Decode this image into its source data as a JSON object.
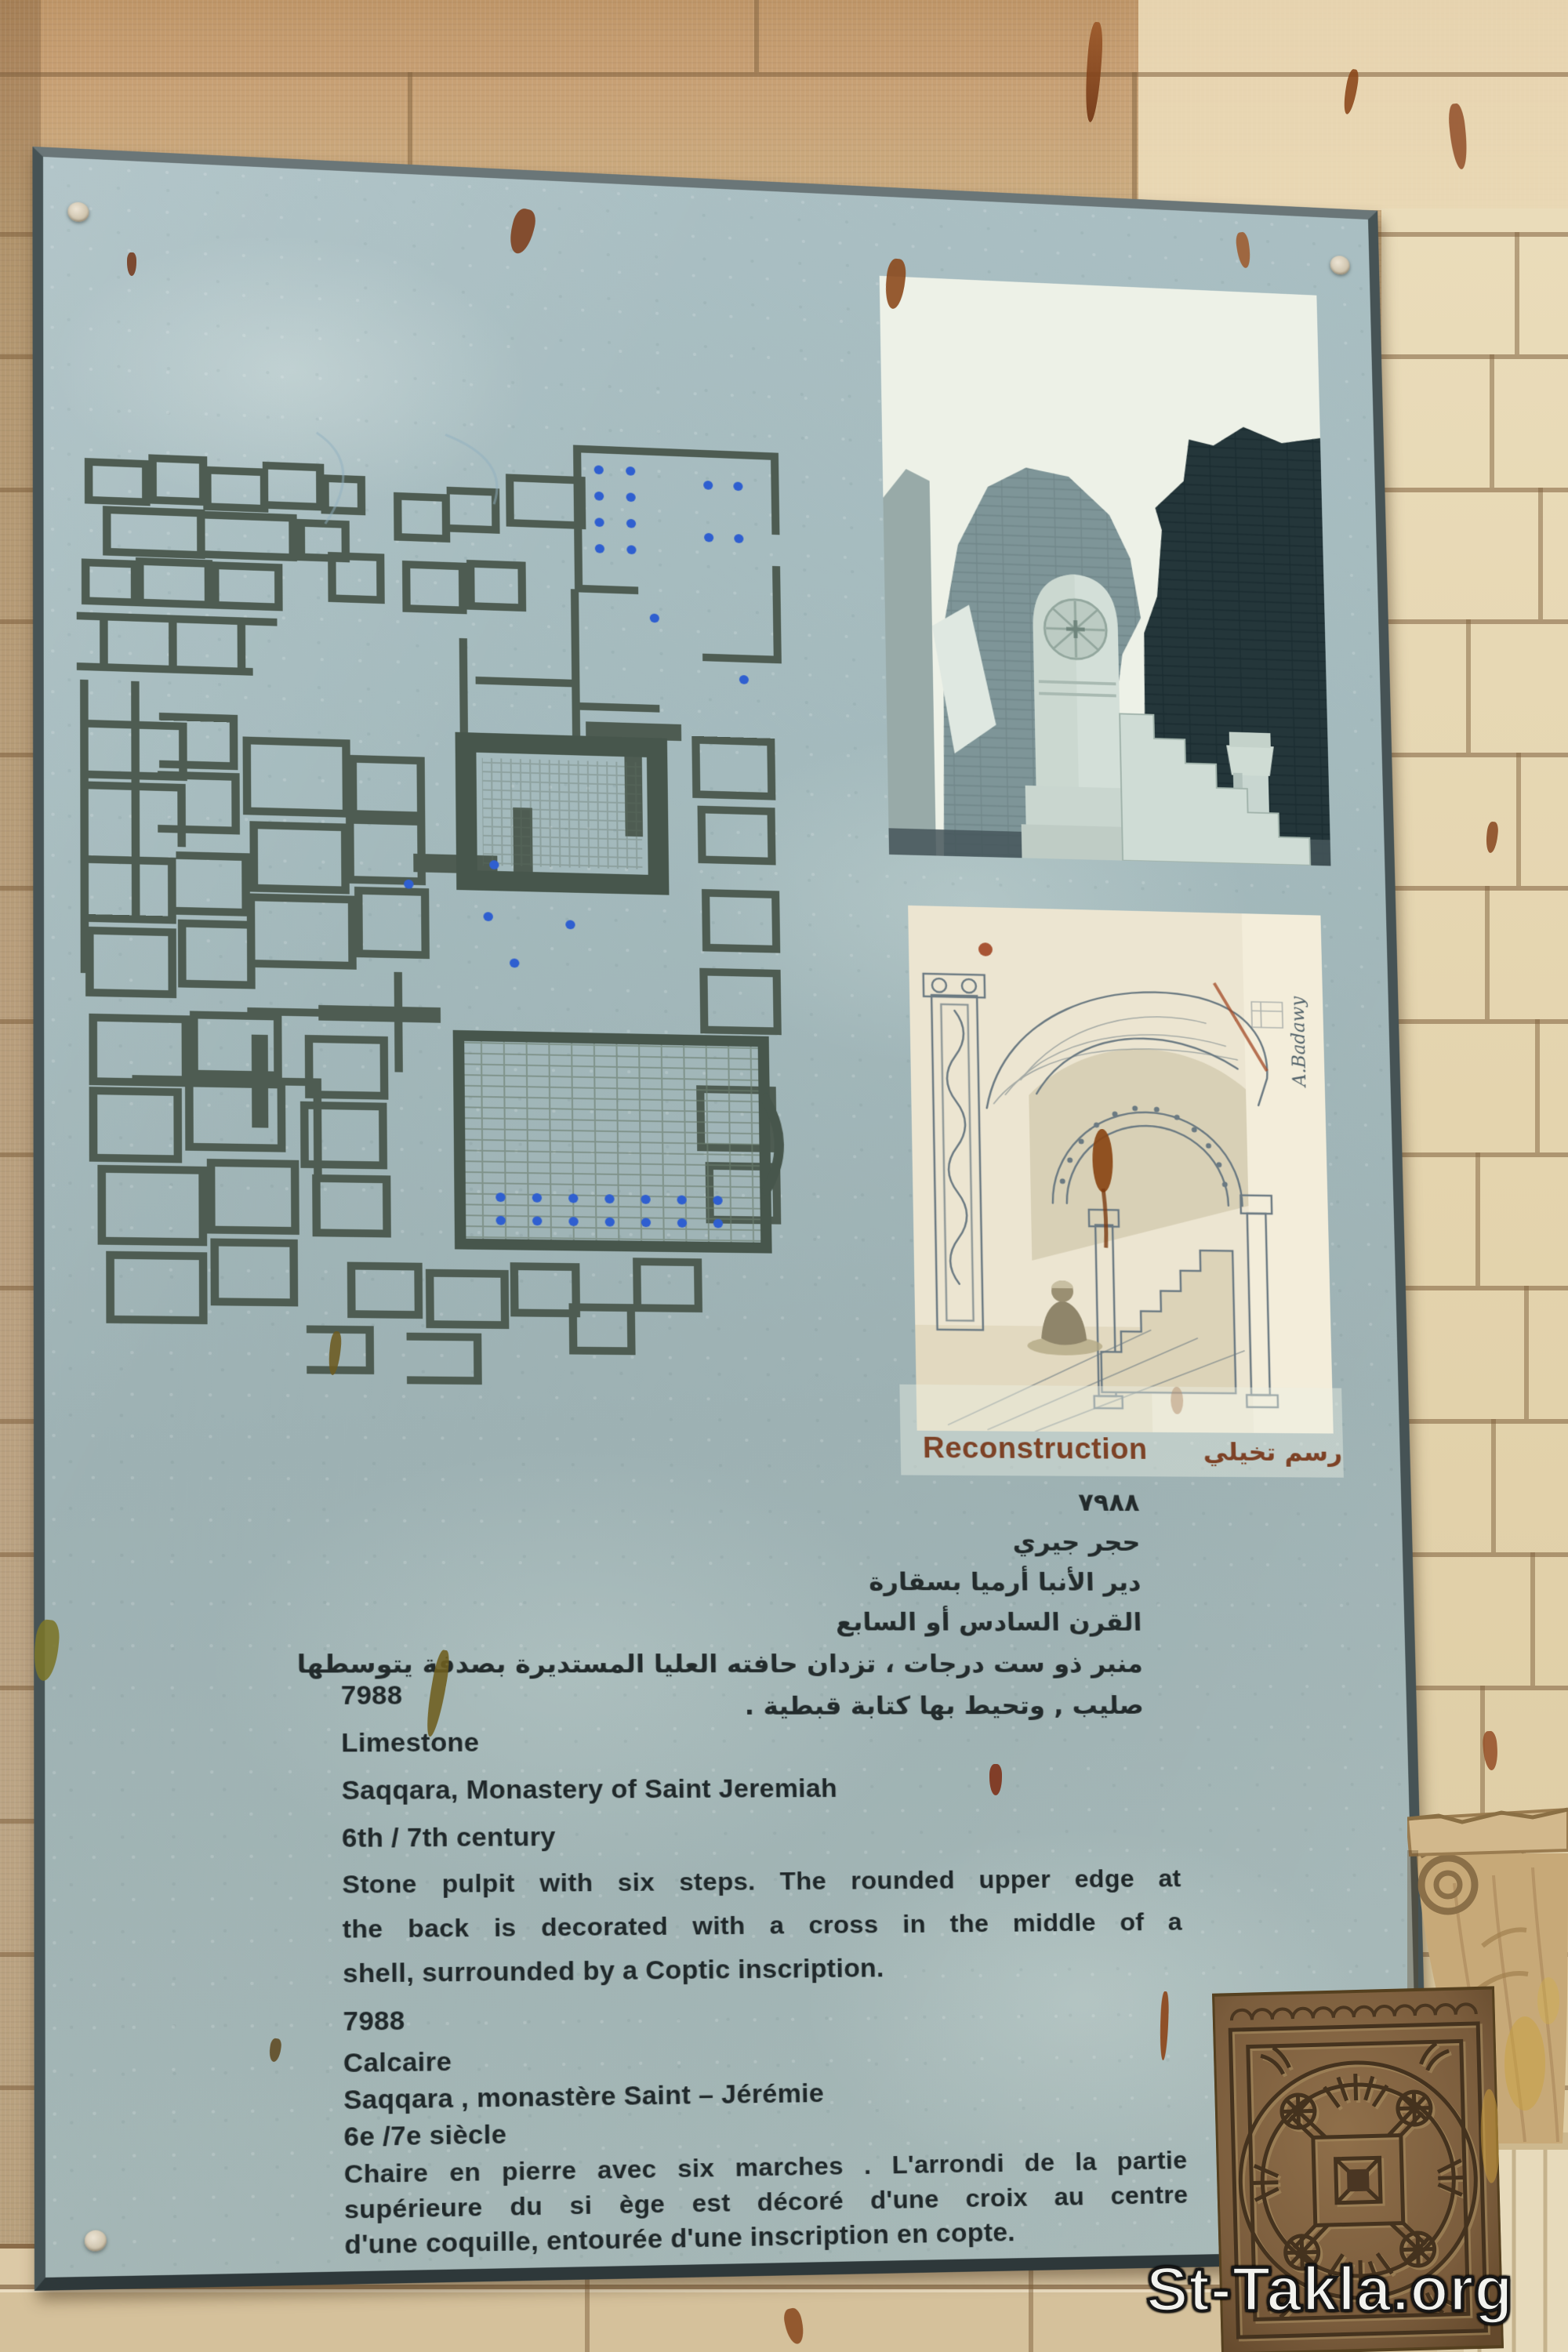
{
  "watermark": "St-Takla.org",
  "sign": {
    "reconstruction_label": "Reconstruction",
    "reconstruction_label_ar": "رسم تخيلي",
    "arabic_lines": [
      "٧٩٨٨",
      "حجر جيري",
      "دير الأنبا أرميا بسقارة",
      "القرن السادس أو السابع",
      "منبر ذو ست درجات ، تزدان حافته العليا المستديرة بصدفة يتوسطها",
      "صليب , وتحيط بها كتابة قبطية ."
    ],
    "english": {
      "number": "7988",
      "material": "Limestone",
      "provenance": "Saqqara, Monastery of Saint Jeremiah",
      "date": "6th / 7th century",
      "description": [
        "Stone pulpit with six steps. The rounded upper edge at",
        "the back is decorated with a cross in the middle of a",
        "shell, surrounded by a Coptic inscription."
      ]
    },
    "french": {
      "number": "7988",
      "material": "Calcaire",
      "provenance": "Saqqara , monastère Saint – Jérémie",
      "date": "6e /7e siècle",
      "description": [
        "Chaire en pierre avec six marches . L'arrondi de la partie",
        "supérieure du si ège est décoré d'une croix au centre",
        "d'une coquille, entourée d'une inscription en copte."
      ]
    },
    "drawing_signature": "A.Badawy",
    "colors": {
      "panel": "#a4b9bc",
      "frame": "#46535 5",
      "accent": "#7d4226",
      "text": "#20282a"
    }
  },
  "graphics": {
    "floor_plan_alt": "Site plan of the monastery with walls, courtyard, church hall and column dots",
    "ruins_photo_alt": "Photograph of the stone pulpit with steps and a column among mud-brick ruins",
    "reconstruction_drawing_alt": "Sketch reconstruction of the pulpit: arch on two columns over six steps with seated figure"
  }
}
